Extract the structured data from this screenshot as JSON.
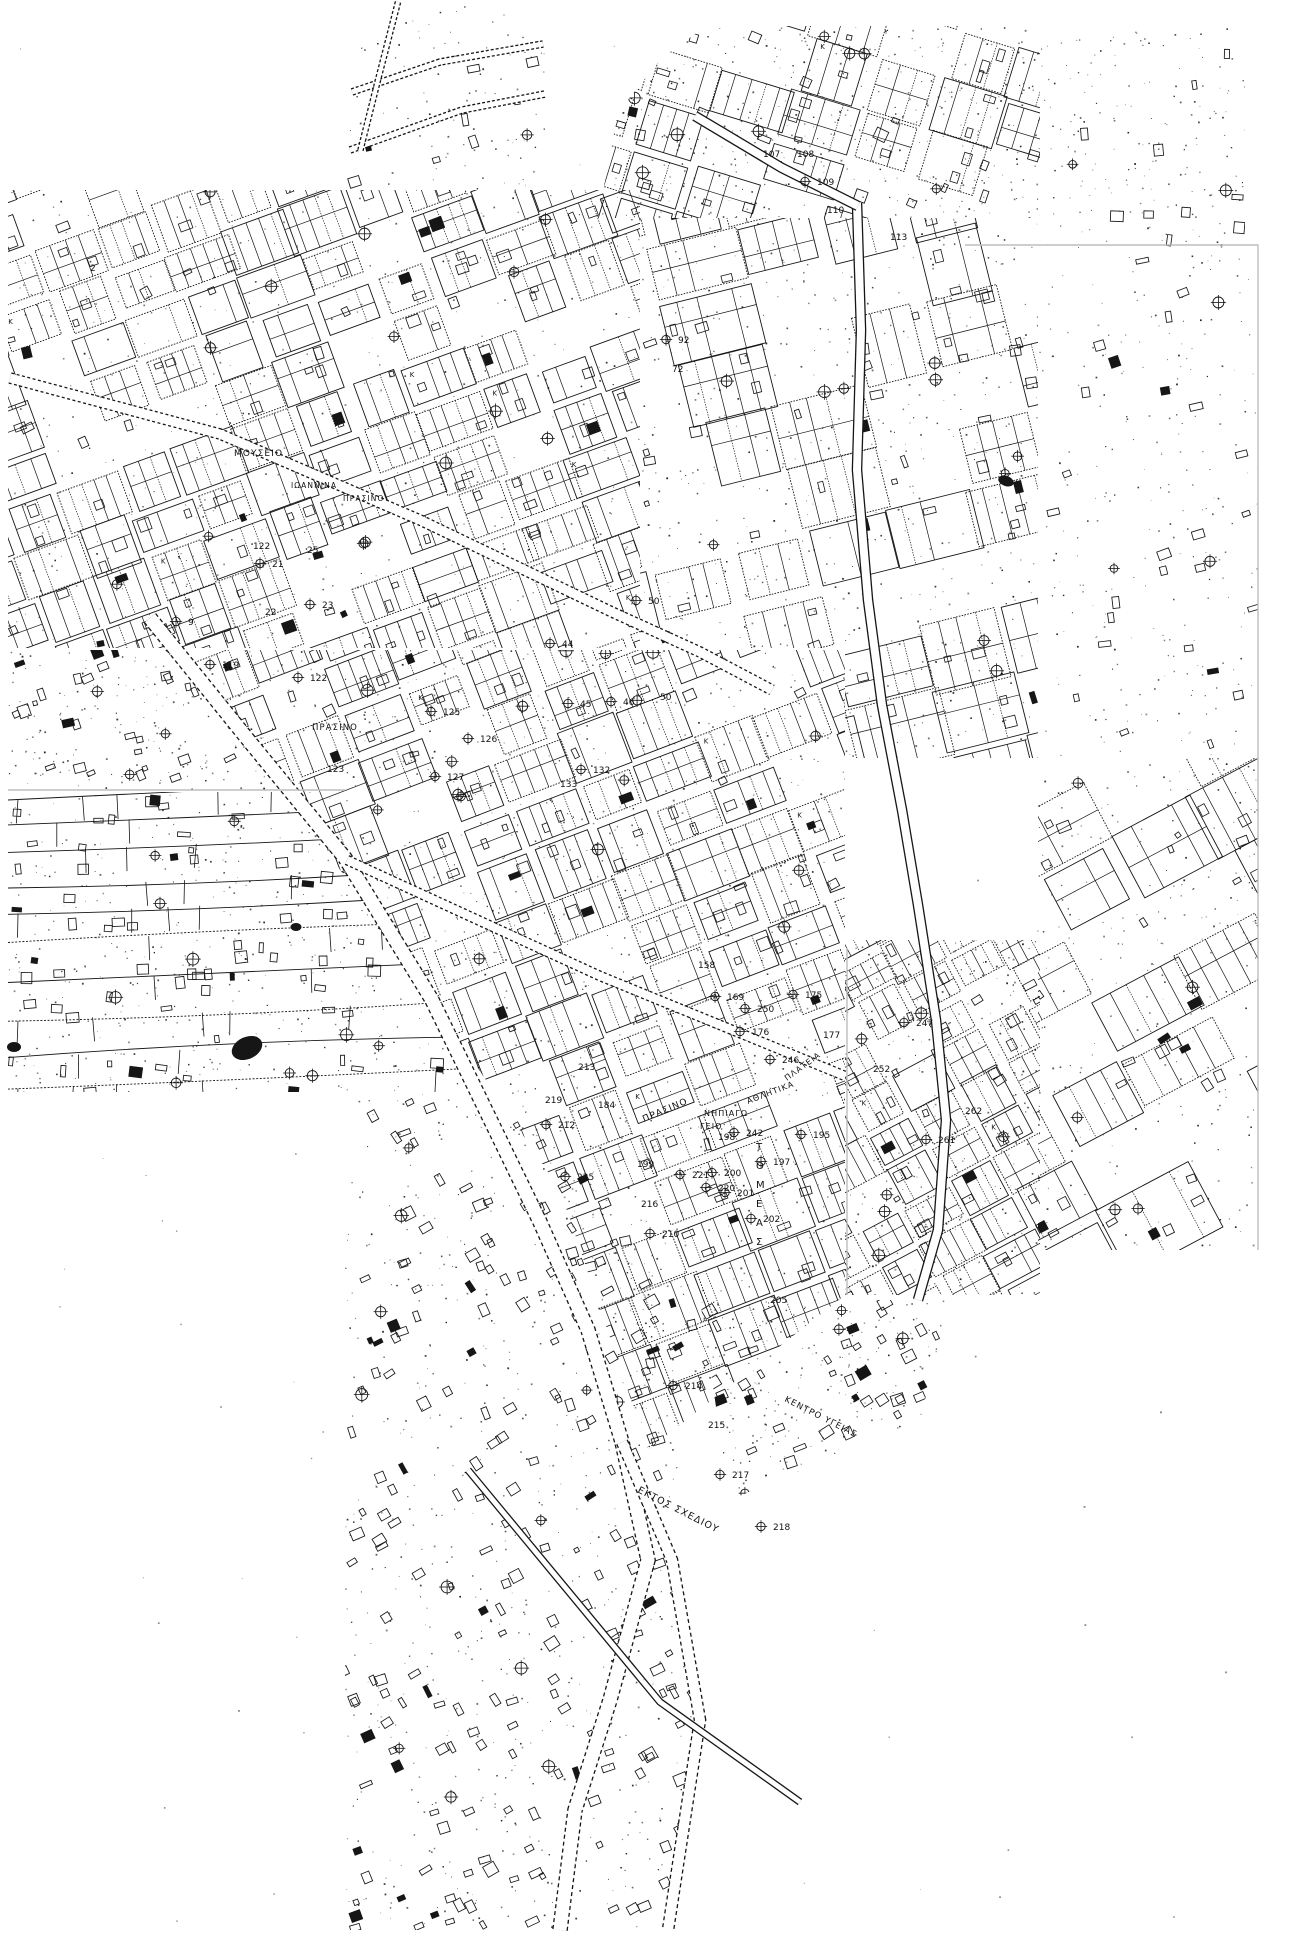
{
  "map": {
    "canvas": {
      "w": 1301,
      "h": 1936,
      "bg": "#ffffff",
      "ink": "#161616",
      "seam": "#bdbdbd"
    },
    "glyphs": {
      "corner_letter": "Κ",
      "cross_marker": "circle-cross"
    },
    "labels": [
      {
        "text": "ΜΟΥΣΕΙΟ",
        "x": 234,
        "y": 456,
        "rot": 0,
        "size": 9
      },
      {
        "text": "ΙΩΑΝΝΙΝΑ",
        "x": 291,
        "y": 488,
        "rot": 0,
        "size": 7.5
      },
      {
        "text": "ΠΡΑΣΙΝΟ",
        "x": 343,
        "y": 501,
        "rot": 0,
        "size": 7.5
      },
      {
        "text": "ΠΡΑΣΙΝΟ",
        "x": 312,
        "y": 730,
        "rot": 0,
        "size": 8.5
      },
      {
        "text": "ΠΡΑΣΙΝΟ",
        "x": 644,
        "y": 1122,
        "rot": -23,
        "size": 9
      },
      {
        "text": "ΝΗΠΙΑΓΩ",
        "x": 704,
        "y": 1116,
        "rot": 0,
        "size": 8
      },
      {
        "text": "ΓΕΙΟ",
        "x": 700,
        "y": 1129,
        "rot": 0,
        "size": 8
      },
      {
        "text": "ΑΘΛΗΤΙΚΑ",
        "x": 748,
        "y": 1104,
        "rot": -21,
        "size": 8
      },
      {
        "text": "ΠΛΑΤΕΙΑ",
        "x": 787,
        "y": 1081,
        "rot": -36,
        "size": 8
      },
      {
        "text": "ΚΕΝΤΡΟ ΥΓΕΙΑΣ",
        "x": 784,
        "y": 1401,
        "rot": 27,
        "size": 8.5
      },
      {
        "text": "ΕΚΤΟΣ ΣΧΕΔΙΟΥ",
        "x": 637,
        "y": 1492,
        "rot": 27,
        "size": 9.5
      },
      {
        "text": "ΤΟΜΕΑΣ",
        "x": 756,
        "y": 1150,
        "rot": 0,
        "size": 10,
        "stacked": true,
        "gap": 19
      }
    ],
    "block_numbers": [
      {
        "n": "2",
        "x": 90,
        "y": 271
      },
      {
        "n": "122",
        "x": 253,
        "y": 549
      },
      {
        "n": "25",
        "x": 307,
        "y": 553
      },
      {
        "n": "21",
        "x": 272,
        "y": 567
      },
      {
        "n": "23",
        "x": 322,
        "y": 608
      },
      {
        "n": "22",
        "x": 265,
        "y": 615
      },
      {
        "n": "9",
        "x": 188,
        "y": 625
      },
      {
        "n": "92",
        "x": 678,
        "y": 343
      },
      {
        "n": "72",
        "x": 672,
        "y": 372
      },
      {
        "n": "50",
        "x": 648,
        "y": 604
      },
      {
        "n": "44",
        "x": 562,
        "y": 647
      },
      {
        "n": "45",
        "x": 580,
        "y": 707
      },
      {
        "n": "46",
        "x": 623,
        "y": 705
      },
      {
        "n": "50",
        "x": 660,
        "y": 700
      },
      {
        "n": "107",
        "x": 763,
        "y": 157
      },
      {
        "n": "108",
        "x": 797,
        "y": 157
      },
      {
        "n": "109",
        "x": 817,
        "y": 185
      },
      {
        "n": "110",
        "x": 827,
        "y": 213
      },
      {
        "n": "113",
        "x": 890,
        "y": 240
      },
      {
        "n": "119",
        "x": 222,
        "y": 668
      },
      {
        "n": "122",
        "x": 310,
        "y": 681
      },
      {
        "n": "123",
        "x": 327,
        "y": 772
      },
      {
        "n": "125",
        "x": 443,
        "y": 715
      },
      {
        "n": "126",
        "x": 480,
        "y": 742
      },
      {
        "n": "127",
        "x": 447,
        "y": 780
      },
      {
        "n": "132",
        "x": 593,
        "y": 773
      },
      {
        "n": "133",
        "x": 560,
        "y": 787
      },
      {
        "n": "158",
        "x": 698,
        "y": 968
      },
      {
        "n": "169",
        "x": 727,
        "y": 1000
      },
      {
        "n": "175",
        "x": 805,
        "y": 998
      },
      {
        "n": "176",
        "x": 752,
        "y": 1035
      },
      {
        "n": "177",
        "x": 823,
        "y": 1038
      },
      {
        "n": "184",
        "x": 598,
        "y": 1108
      },
      {
        "n": "195",
        "x": 813,
        "y": 1138
      },
      {
        "n": "197",
        "x": 773,
        "y": 1165
      },
      {
        "n": "198",
        "x": 718,
        "y": 1140
      },
      {
        "n": "199",
        "x": 637,
        "y": 1167
      },
      {
        "n": "200",
        "x": 724,
        "y": 1176
      },
      {
        "n": "201",
        "x": 737,
        "y": 1196
      },
      {
        "n": "202",
        "x": 763,
        "y": 1222
      },
      {
        "n": "205",
        "x": 770,
        "y": 1303
      },
      {
        "n": "210",
        "x": 662,
        "y": 1237
      },
      {
        "n": "212",
        "x": 558,
        "y": 1128
      },
      {
        "n": "213",
        "x": 578,
        "y": 1070
      },
      {
        "n": "214",
        "x": 685,
        "y": 1389
      },
      {
        "n": "215",
        "x": 708,
        "y": 1428
      },
      {
        "n": "216",
        "x": 641,
        "y": 1207
      },
      {
        "n": "217",
        "x": 732,
        "y": 1478
      },
      {
        "n": "218",
        "x": 773,
        "y": 1530
      },
      {
        "n": "219",
        "x": 545,
        "y": 1103
      },
      {
        "n": "220",
        "x": 718,
        "y": 1191
      },
      {
        "n": "221",
        "x": 692,
        "y": 1178
      },
      {
        "n": "225",
        "x": 577,
        "y": 1180
      },
      {
        "n": "242",
        "x": 746,
        "y": 1136
      },
      {
        "n": "246",
        "x": 782,
        "y": 1063
      },
      {
        "n": "247",
        "x": 916,
        "y": 1026
      },
      {
        "n": "250",
        "x": 757,
        "y": 1012
      },
      {
        "n": "252",
        "x": 873,
        "y": 1072
      },
      {
        "n": "261",
        "x": 938,
        "y": 1143
      },
      {
        "n": "262",
        "x": 965,
        "y": 1114
      }
    ],
    "districts": [
      {
        "id": "top-left-grid",
        "type": "grid",
        "poly": [
          [
            8,
            190
          ],
          [
            640,
            190
          ],
          [
            640,
            648
          ],
          [
            8,
            648
          ]
        ],
        "angle": -20,
        "block": [
          54,
          40
        ],
        "street": 7,
        "parcel": 14,
        "density": 0.88,
        "seed": 11,
        "crosses": 14,
        "rects": 30,
        "dots": 520
      },
      {
        "id": "top-notch-roads",
        "type": "scatter",
        "poly": [
          [
            345,
            5
          ],
          [
            545,
            5
          ],
          [
            545,
            195
          ],
          [
            345,
            195
          ]
        ],
        "angle": -15,
        "seed": 7,
        "crosses": 1,
        "rects": 8,
        "dots": 90
      },
      {
        "id": "tilted-ne-sheet",
        "type": "grid",
        "poly": [
          [
            598,
            218
          ],
          [
            618,
            112
          ],
          [
            662,
            58
          ],
          [
            706,
            26
          ],
          [
            1040,
            26
          ],
          [
            1040,
            218
          ]
        ],
        "angle": 17,
        "block": [
          64,
          46
        ],
        "street": 6,
        "parcel": 16,
        "density": 0.72,
        "seed": 21,
        "crosses": 8,
        "rects": 20,
        "dots": 420
      },
      {
        "id": "east-mid-grid",
        "type": "grid",
        "poly": [
          [
            640,
            218
          ],
          [
            1038,
            218
          ],
          [
            1038,
            758
          ],
          [
            845,
            758
          ],
          [
            845,
            648
          ],
          [
            640,
            648
          ]
        ],
        "angle": -14,
        "block": [
          76,
          56
        ],
        "street": 7,
        "parcel": 19,
        "density": 0.62,
        "seed": 31,
        "crosses": 10,
        "rects": 26,
        "dots": 520
      },
      {
        "id": "far-east-sparse",
        "type": "scatter",
        "poly": [
          [
            1038,
            248
          ],
          [
            1258,
            248
          ],
          [
            1258,
            758
          ],
          [
            1038,
            758
          ]
        ],
        "angle": -14,
        "seed": 41,
        "crosses": 3,
        "rects": 26,
        "dots": 230
      },
      {
        "id": "far-east-grid",
        "type": "grid",
        "poly": [
          [
            1038,
            758
          ],
          [
            1258,
            758
          ],
          [
            1258,
            1250
          ],
          [
            1038,
            1250
          ]
        ],
        "angle": -28,
        "block": [
          84,
          58
        ],
        "street": 7,
        "parcel": 20,
        "density": 0.5,
        "seed": 43,
        "crosses": 5,
        "rects": 16,
        "dots": 260
      },
      {
        "id": "se-dense-grid",
        "type": "grid",
        "poly": [
          [
            845,
            940
          ],
          [
            1040,
            940
          ],
          [
            1040,
            1295
          ],
          [
            845,
            1295
          ]
        ],
        "angle": -28,
        "block": [
          46,
          34
        ],
        "street": 6,
        "parcel": 12,
        "density": 0.9,
        "seed": 51,
        "crosses": 6,
        "rects": 14,
        "dots": 300
      },
      {
        "id": "central-grid",
        "type": "grid",
        "poly": [
          [
            165,
            650
          ],
          [
            845,
            650
          ],
          [
            845,
            1295
          ],
          [
            648,
            1450
          ],
          [
            560,
            1190
          ],
          [
            432,
            1000
          ],
          [
            250,
            742
          ]
        ],
        "angle": -21,
        "block": [
          56,
          42
        ],
        "street": 8,
        "parcel": 14,
        "density": 0.86,
        "seed": 61,
        "crosses": 16,
        "rects": 30,
        "dots": 900
      },
      {
        "id": "gap-scatter",
        "type": "scatter",
        "poly": [
          [
            8,
            650
          ],
          [
            160,
            650
          ],
          [
            300,
            790
          ],
          [
            8,
            790
          ]
        ],
        "angle": -18,
        "seed": 71,
        "crosses": 3,
        "rects": 28,
        "dots": 160
      },
      {
        "id": "west-strips",
        "type": "strips",
        "poly": [
          [
            8,
            792
          ],
          [
            300,
            792
          ],
          [
            432,
            1002
          ],
          [
            470,
            1092
          ],
          [
            8,
            1092
          ]
        ],
        "gap": 30,
        "slope": -0.045,
        "ticks": 0.35,
        "seed": 81,
        "crosses": 10,
        "rects": 70,
        "dots": 380
      },
      {
        "id": "south-band",
        "type": "scatter",
        "poly": [
          [
            345,
            1092
          ],
          [
            520,
            1092
          ],
          [
            695,
            1300
          ],
          [
            672,
            1560
          ],
          [
            700,
            1720
          ],
          [
            665,
            1930
          ],
          [
            345,
            1930
          ]
        ],
        "angle": -25,
        "seed": 91,
        "crosses": 12,
        "rects": 210,
        "dots": 650
      },
      {
        "id": "se-taper",
        "type": "scatter",
        "poly": [
          [
            700,
            1300
          ],
          [
            950,
            1300
          ],
          [
            920,
            1420
          ],
          [
            730,
            1500
          ]
        ],
        "angle": -25,
        "seed": 95,
        "crosses": 4,
        "rects": 40,
        "dots": 200
      },
      {
        "id": "ne-corner-dots",
        "type": "scatter",
        "poly": [
          [
            1040,
            28
          ],
          [
            1245,
            28
          ],
          [
            1245,
            248
          ],
          [
            1040,
            248
          ]
        ],
        "angle": 0,
        "seed": 13,
        "crosses": 2,
        "rects": 10,
        "dots": 170
      }
    ],
    "roads": [
      {
        "name": "main-avenue",
        "width": 13,
        "dash": "4 3",
        "pts": [
          [
            150,
            618
          ],
          [
            250,
            742
          ],
          [
            345,
            858
          ],
          [
            432,
            1000
          ],
          [
            472,
            1082
          ],
          [
            540,
            1222
          ],
          [
            588,
            1330
          ],
          [
            622,
            1442
          ],
          [
            648,
            1560
          ],
          [
            610,
            1700
          ],
          [
            575,
            1810
          ],
          [
            560,
            1930
          ]
        ]
      },
      {
        "name": "avenue-branch",
        "width": 10,
        "dash": "4 3",
        "pts": [
          [
            622,
            1442
          ],
          [
            672,
            1560
          ],
          [
            700,
            1720
          ],
          [
            668,
            1930
          ]
        ]
      },
      {
        "name": "museum-street",
        "width": 9,
        "dash": "3 2.5",
        "pts": [
          [
            10,
            378
          ],
          [
            220,
            434
          ],
          [
            420,
            520
          ],
          [
            612,
            612
          ],
          [
            700,
            652
          ],
          [
            772,
            690
          ]
        ]
      },
      {
        "name": "east-highway",
        "width": 8,
        "dash": "",
        "pts": [
          [
            857,
            203
          ],
          [
            861,
            330
          ],
          [
            857,
            470
          ],
          [
            868,
            600
          ],
          [
            882,
            705
          ],
          [
            902,
            810
          ],
          [
            918,
            905
          ],
          [
            936,
            1020
          ],
          [
            946,
            1120
          ],
          [
            938,
            1230
          ],
          [
            918,
            1300
          ]
        ]
      },
      {
        "name": "ne-sheet-road",
        "width": 8,
        "dash": "",
        "pts": [
          [
            695,
            116
          ],
          [
            782,
            168
          ],
          [
            858,
            206
          ]
        ]
      },
      {
        "name": "central-cross-street",
        "width": 8,
        "dash": "3 2.5",
        "pts": [
          [
            347,
            860
          ],
          [
            600,
            976
          ],
          [
            845,
            1076
          ]
        ]
      },
      {
        "name": "top-curve-a",
        "width": 5,
        "dash": "3 2",
        "pts": [
          [
            352,
            92
          ],
          [
            440,
            62
          ],
          [
            543,
            44
          ]
        ]
      },
      {
        "name": "top-curve-b",
        "width": 5,
        "dash": "3 2",
        "pts": [
          [
            350,
            150
          ],
          [
            462,
            110
          ],
          [
            545,
            94
          ]
        ]
      },
      {
        "name": "top-curve-c",
        "width": 4,
        "dash": "3 2",
        "pts": [
          [
            398,
            2
          ],
          [
            378,
            80
          ],
          [
            360,
            152
          ]
        ]
      },
      {
        "name": "south-crossing",
        "width": 5,
        "dash": "",
        "pts": [
          [
            468,
            1470
          ],
          [
            660,
            1702
          ],
          [
            800,
            1802
          ]
        ]
      }
    ],
    "seams": [
      {
        "pts": [
          [
            965,
            245
          ],
          [
            1258,
            245
          ],
          [
            1258,
            1250
          ]
        ]
      },
      {
        "pts": [
          [
            8,
            790
          ],
          [
            345,
            790
          ]
        ]
      },
      {
        "pts": [
          [
            847,
            948
          ],
          [
            847,
            1295
          ]
        ]
      }
    ],
    "blobs": [
      {
        "x": 247,
        "y": 1048,
        "rx": 16,
        "ry": 11,
        "rot": -25
      },
      {
        "x": 296,
        "y": 927,
        "rx": 5.5,
        "ry": 4,
        "rot": 0
      },
      {
        "x": 1006,
        "y": 481,
        "rx": 8,
        "ry": 5,
        "rot": 20
      },
      {
        "x": 14,
        "y": 1047,
        "rx": 7,
        "ry": 5,
        "rot": 0
      }
    ]
  }
}
